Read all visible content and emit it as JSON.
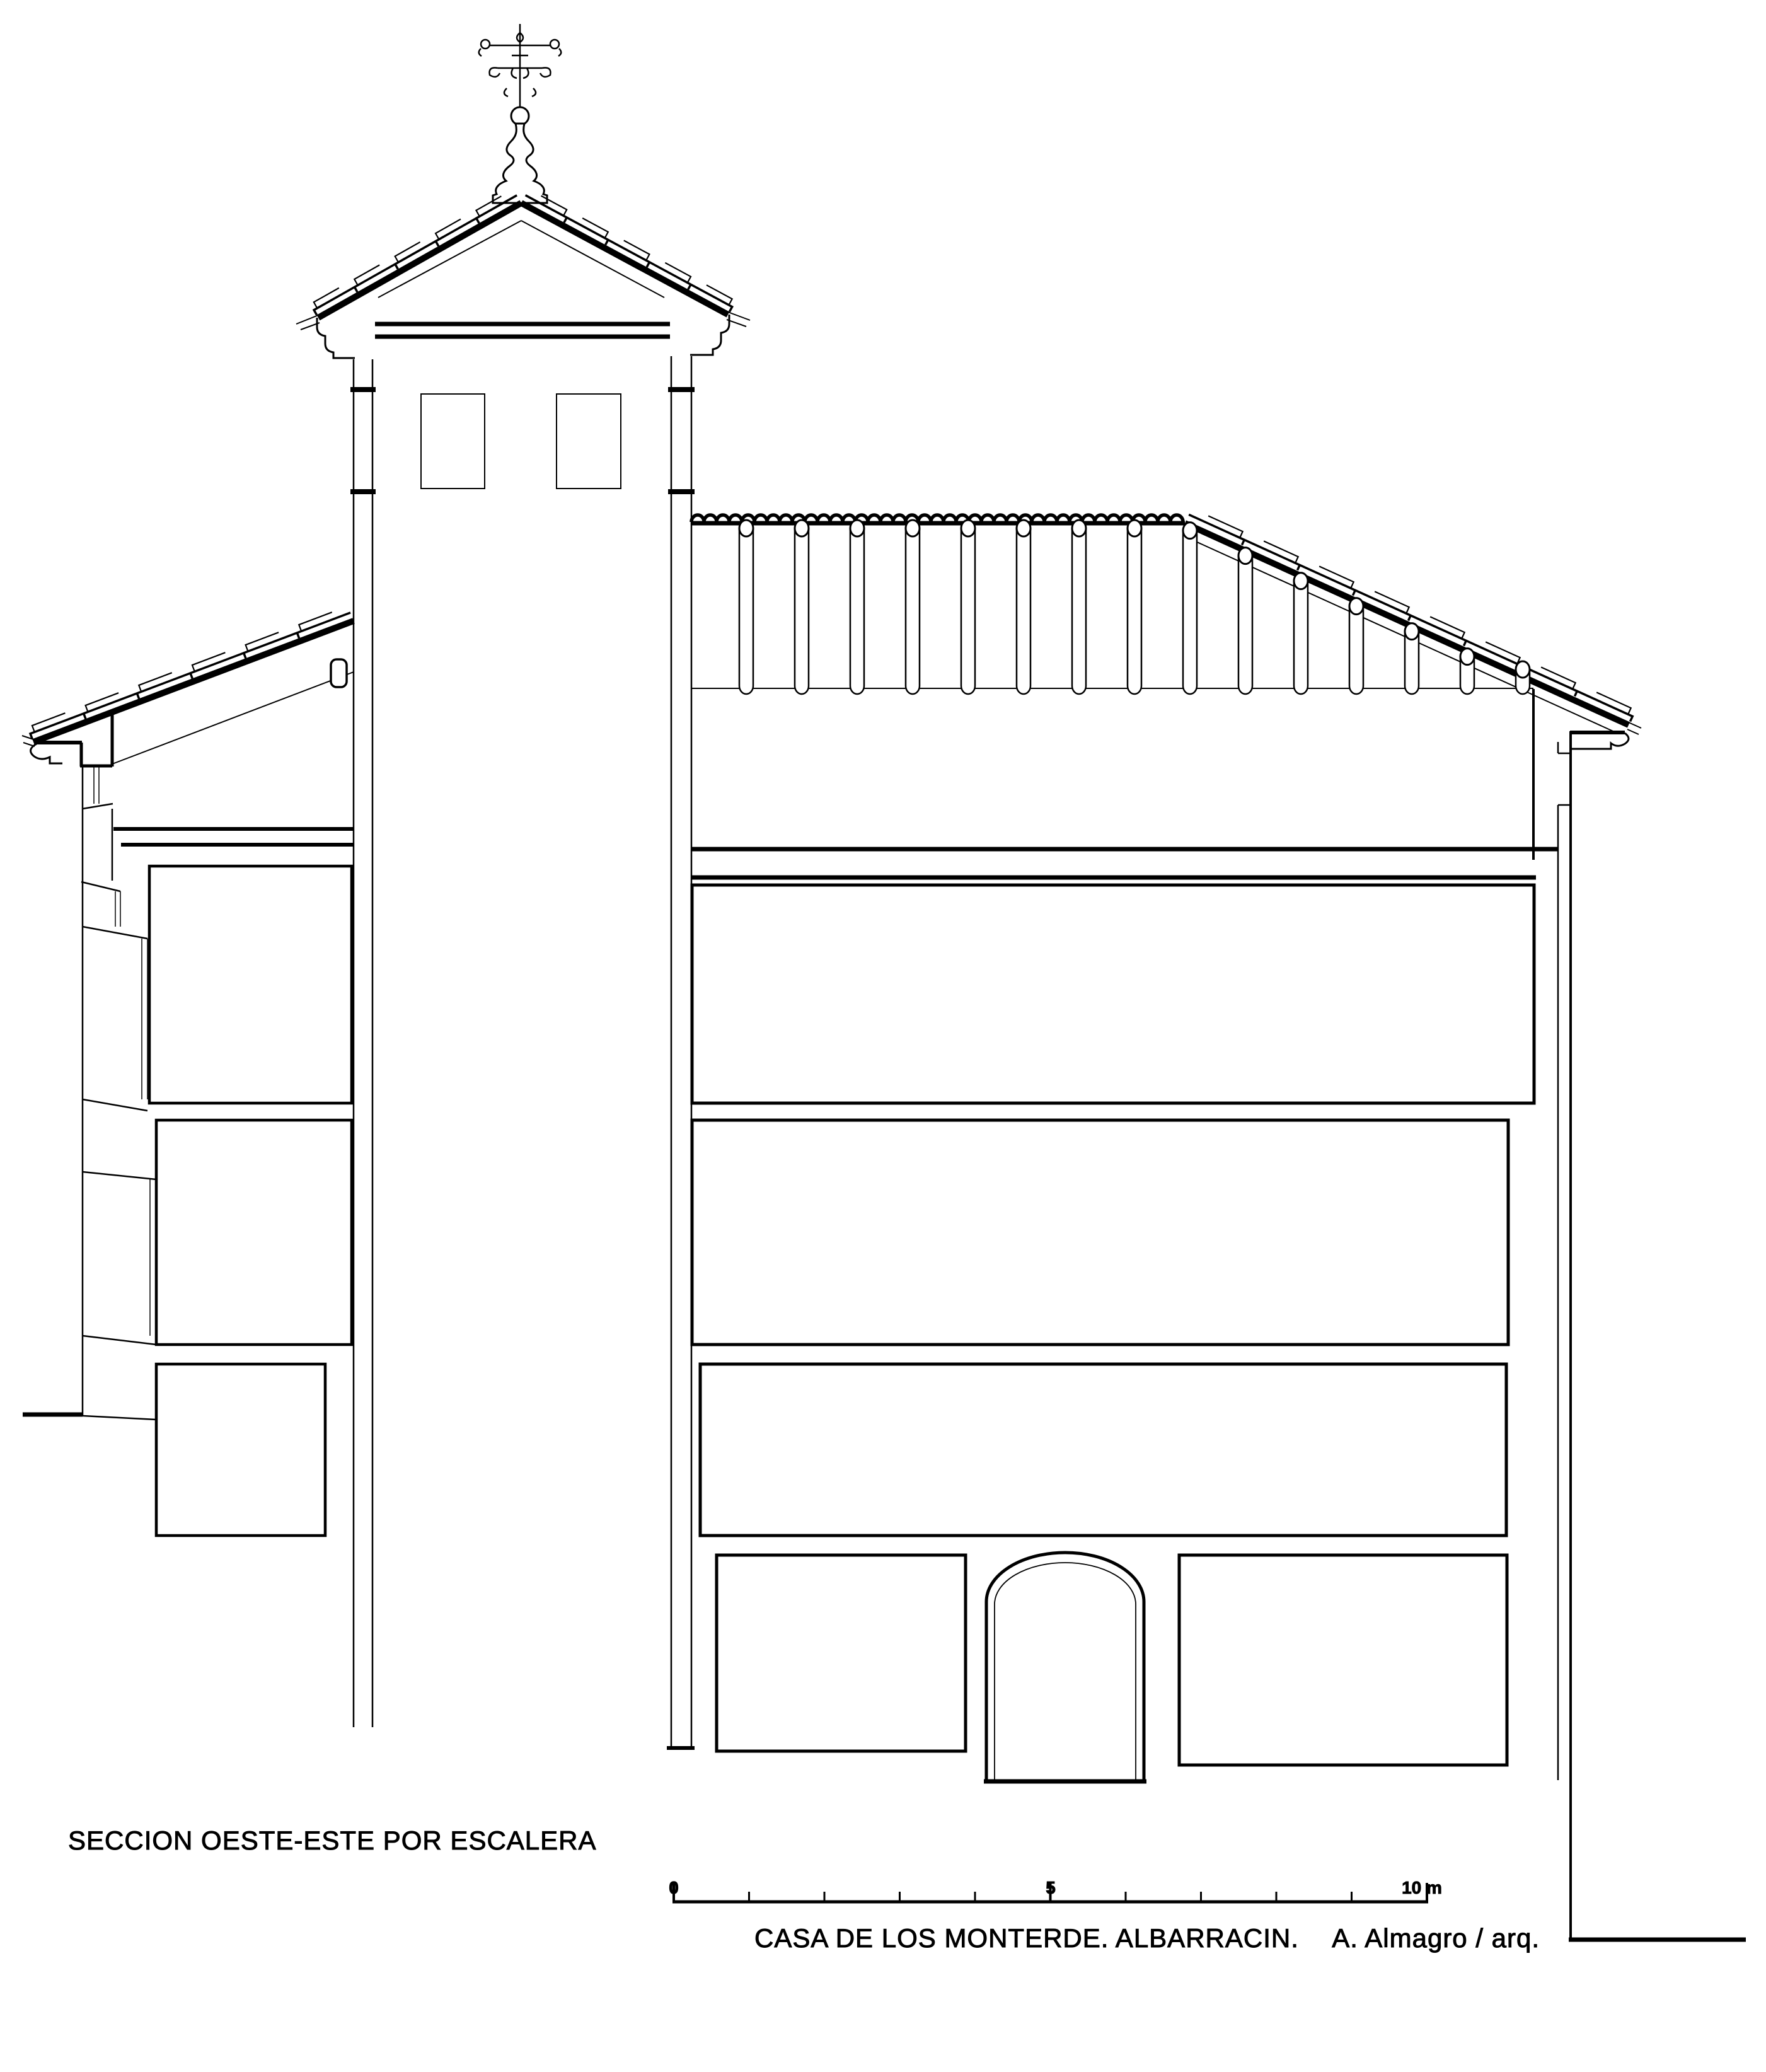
{
  "drawing": {
    "type": "architectural_section",
    "title": "SECCION OESTE-ESTE POR ESCALERA",
    "caption": {
      "project": "CASA DE LOS MONTERDE. ALBARRACIN.",
      "author": "A. Almagro / arq."
    },
    "scale_bar": {
      "labels": [
        "0",
        "5",
        "10 m"
      ],
      "meters_total": 10,
      "minor_step_m": 1,
      "major_ticks_m": [
        0,
        5,
        10
      ]
    },
    "colors": {
      "ink": "#000000",
      "paper": "#ffffff"
    }
  }
}
